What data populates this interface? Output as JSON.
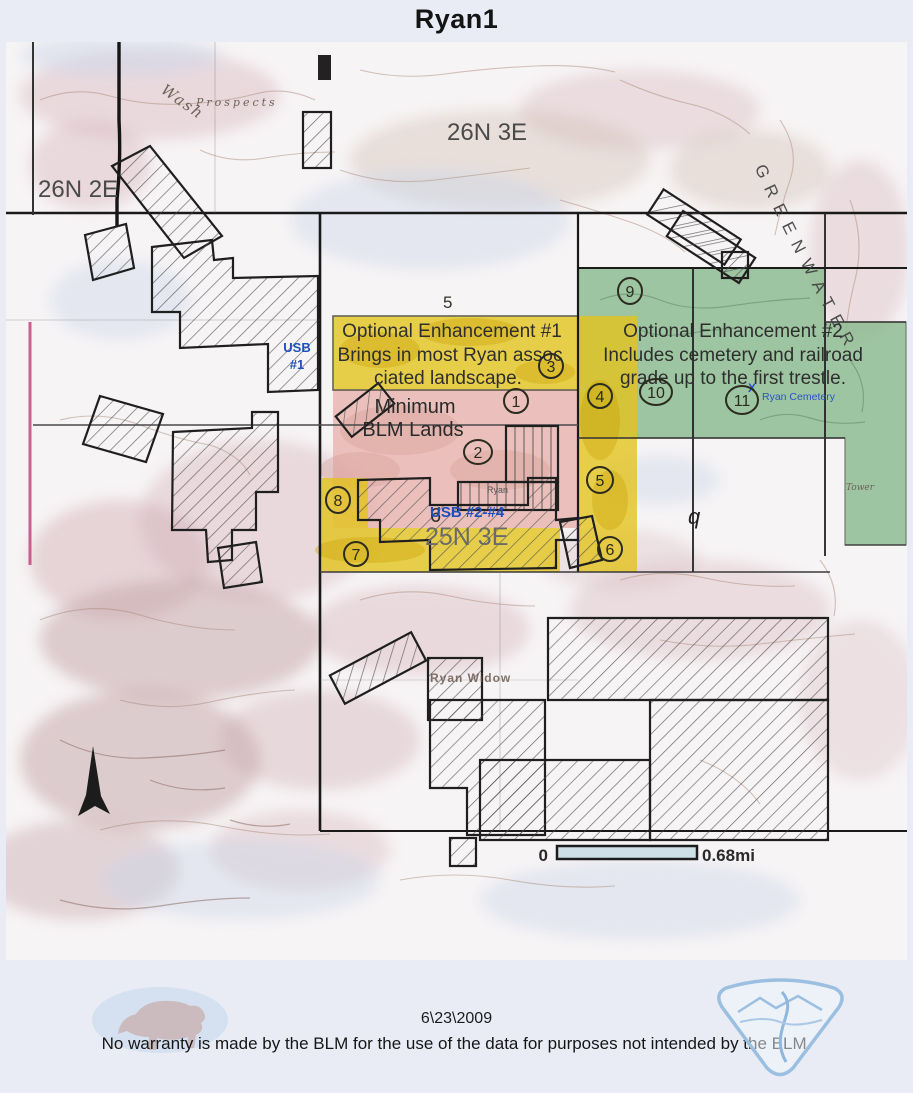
{
  "page": {
    "title": "Ryan1",
    "date": "6\\23\\2009",
    "disclaimer": "No warranty is made by the BLM for the use of the data for purposes not intended by the BLM."
  },
  "map": {
    "townships": {
      "t26n2e": "26N 2E",
      "t26n3e": "26N 3E",
      "t25n3e": "25N 3E"
    },
    "place_labels": {
      "greenwater": "GREENWATER",
      "wash": "Wash",
      "prospects": "Prospects",
      "ryan_widow": "Ryan Widow",
      "ryan": "Ryan",
      "tower": "Tower",
      "section_5": "5",
      "section_6": "6",
      "section_q": "q"
    },
    "overlays": {
      "enhancement1": {
        "highlight_color": "#e3c319",
        "lines": [
          "Optional Enhancement #1",
          "Brings in most Ryan assoc",
          "ciated landscape."
        ]
      },
      "enhancement2": {
        "highlight_color": "#86b88a",
        "lines": [
          "Optional Enhancement #2",
          "Includes cemetery and railroad",
          "grade up to the first trestle."
        ]
      },
      "minimum_blm": {
        "highlight_color": "#e7b3ae",
        "lines": [
          "Minimum",
          "BLM Lands"
        ]
      }
    },
    "usb": {
      "color": "#1d4fbe",
      "usb1": [
        "USB",
        "#1"
      ],
      "usb2_4": "USB #2-#4"
    },
    "cemetery": {
      "mark": "X",
      "label": "Ryan Cemetery"
    },
    "circled": [
      "1",
      "2",
      "3",
      "4",
      "5",
      "6",
      "7",
      "8",
      "9",
      "10",
      "11"
    ],
    "scale": {
      "zero": "0",
      "distance": "0.68mi"
    }
  }
}
